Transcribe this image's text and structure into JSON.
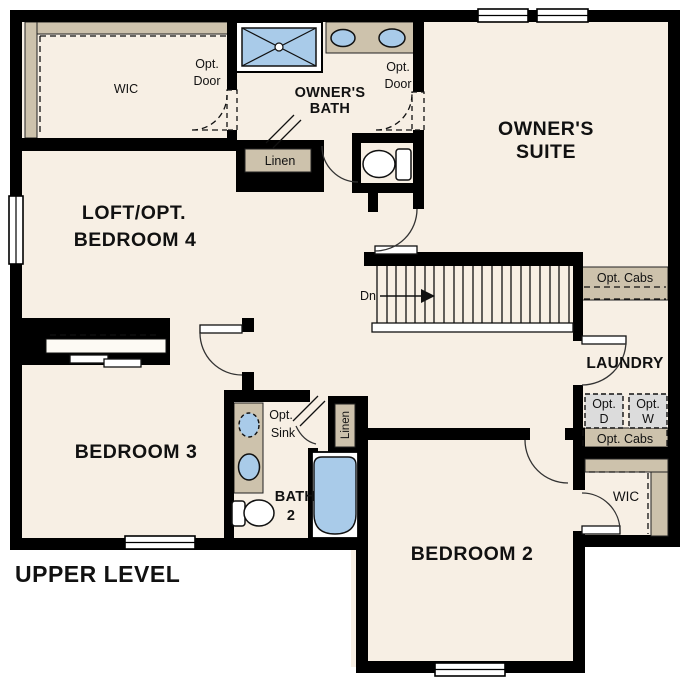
{
  "title": "UPPER LEVEL",
  "colors": {
    "floor": "#f7efe4",
    "wall": "#000000",
    "counter_tan": "#cdc2ac",
    "fixture_blue": "#a9cbe9",
    "appliance_gray": "#dcdcdc",
    "background": "#ffffff"
  },
  "rooms": {
    "wic_top": {
      "label": "WIC"
    },
    "owners_bath": {
      "line1": "OWNER'S",
      "line2": "BATH"
    },
    "owners_suite": {
      "line1": "OWNER'S",
      "line2": "SUITE"
    },
    "loft": {
      "line1": "LOFT/OPT.",
      "line2": "BEDROOM 4"
    },
    "laundry": {
      "label": "LAUNDRY"
    },
    "bedroom3": {
      "label": "BEDROOM 3"
    },
    "bath2": {
      "line1": "BATH",
      "line2": "2"
    },
    "bedroom2": {
      "label": "BEDROOM 2"
    },
    "wic_bottom": {
      "label": "WIC"
    }
  },
  "annotations": {
    "opt_door_left": {
      "line1": "Opt.",
      "line2": "Door"
    },
    "opt_door_right": {
      "line1": "Opt.",
      "line2": "Door"
    },
    "linen_top": {
      "label": "Linen"
    },
    "linen_bath2": {
      "label": "Linen"
    },
    "opt_sink": {
      "line1": "Opt.",
      "line2": "Sink"
    },
    "stairs_dn": {
      "label": "Dn"
    },
    "opt_cabs_top": {
      "label": "Opt. Cabs"
    },
    "opt_cabs_bottom": {
      "label": "Opt. Cabs"
    },
    "opt_dryer": {
      "line1": "Opt.",
      "line2": "D"
    },
    "opt_washer": {
      "line1": "Opt.",
      "line2": "W"
    }
  },
  "fixtures": [
    "shower-icon",
    "double-vanity-sinks-icon",
    "toilet-icon",
    "bathtub-icon",
    "single-vanity-icon",
    "closet-shelf-icon",
    "sliding-doors-icon",
    "stairs-down-icon",
    "window-icon",
    "door-swing-icon"
  ]
}
